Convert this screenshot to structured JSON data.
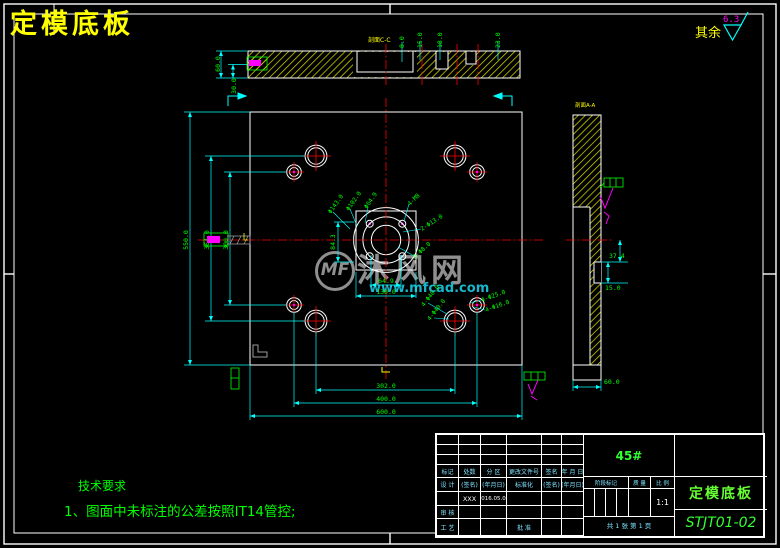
{
  "drawing": {
    "title": "定模底板",
    "surface": {
      "label": "其余",
      "value": "6.3"
    },
    "tech_req": {
      "heading": "技术要求",
      "item": "1、图面中未标注的公差按照IT14管控;"
    },
    "watermark": {
      "logo": "MF",
      "brand": "沐风网",
      "url": "www.mfcad.com"
    },
    "sections": {
      "top": "剖面C-C",
      "side": "剖面A-A"
    }
  },
  "top_view": {
    "dims": {
      "left_outer": "60.0",
      "left_inner": "30.0",
      "top": [
        "8.0",
        "15.0",
        "18.0",
        "23.0"
      ]
    }
  },
  "plan_view": {
    "dims": {
      "height": "550.0",
      "row_large": "364.0",
      "row_small": "300.0",
      "col_large": "302.0",
      "col_small": "400.0",
      "width": "600.0",
      "pocket_width": "130.0",
      "bore_width": "64.9",
      "pocket_offset": "84.3"
    },
    "labels": {
      "bc_outer": "Φ143.0",
      "bc_mid": "Φ102.0",
      "bore": "Φ64.9",
      "tapped": "4-M8",
      "pair_large": "2-Φ13.0",
      "pair_small": "2-Φ8.0",
      "cb_outer": "4-Φ48.0",
      "cb_inner": "4-Φ40.0",
      "sh_outer": "4-Φ25.0",
      "sh_inner": "4-Φ16.0"
    }
  },
  "side_view": {
    "dims": {
      "offset": "37.4",
      "notch": "15.0",
      "thickness": "60.0"
    }
  },
  "title_block": {
    "material": "45#",
    "part_name": "定模底板",
    "drawing_no": "STJT01-02",
    "scale": "1:1",
    "sheet": "共 1 张  第 1 页",
    "rev_header": [
      "标记",
      "处数",
      "分 区",
      "更改文件号",
      "签名",
      "年 月 日"
    ],
    "sign_header": [
      "设 计",
      "(签名)",
      "(年月日)",
      "标准化",
      "(签名)",
      "(年月日)"
    ],
    "designer": "XXX",
    "date": "2016.05.06",
    "audit": "审 核",
    "process": "工 艺",
    "approve": "批 准",
    "stage": [
      "阶段标记",
      "质 量",
      "比 例"
    ]
  }
}
